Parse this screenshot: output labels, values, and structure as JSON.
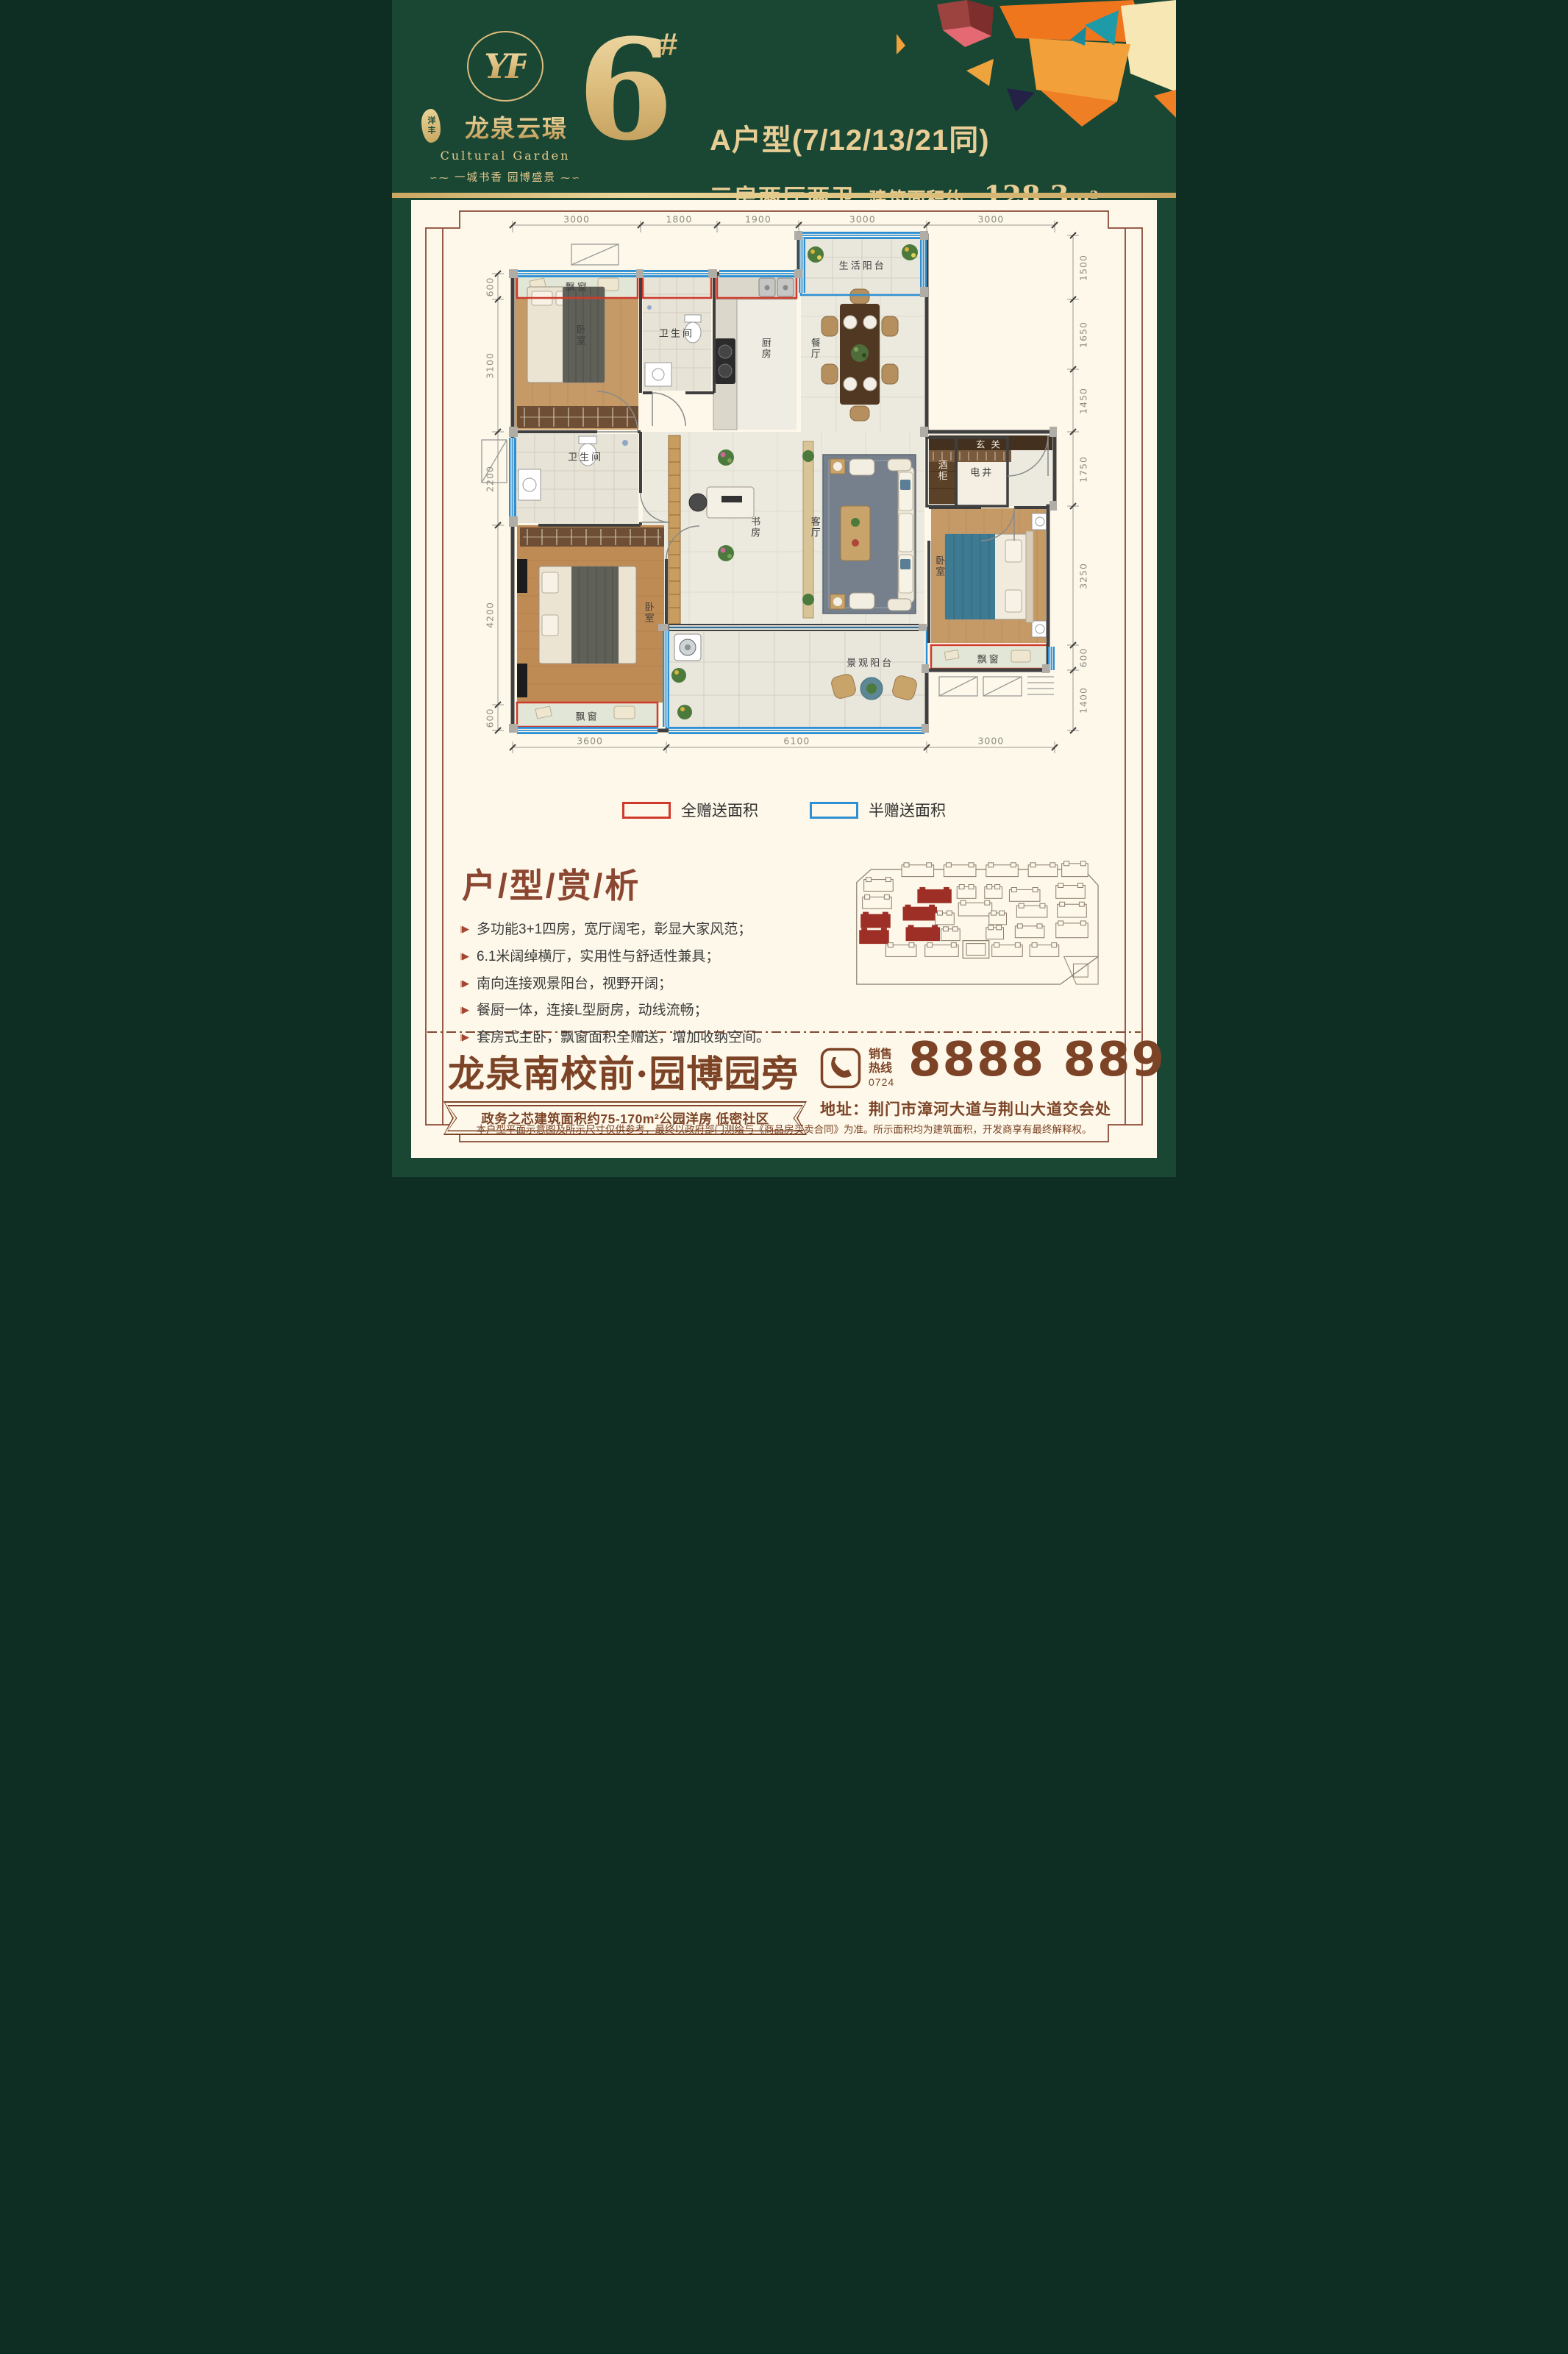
{
  "header": {
    "logo": {
      "monogram": "YF",
      "seal": "洋丰",
      "name": "龙泉云璟",
      "subtitle": "Cultural Garden",
      "tagline": "一城书香  园博盛景"
    },
    "building_no": "6",
    "building_no_suffix": "#",
    "unit_line": "A户型(7/12/13/21同)",
    "layout_line": "三房两厅两卫",
    "area_label": "建筑面积约：",
    "area_value": "128.3",
    "area_unit": "m²"
  },
  "floor_plan": {
    "dims_top": [
      "3000",
      "1800",
      "1900",
      "3000",
      "3000"
    ],
    "dims_left": [
      "600",
      "3100",
      "2200",
      "4200",
      "600"
    ],
    "dims_right": [
      "1500",
      "1650",
      "1450",
      "1750",
      "3250",
      "600",
      "1400"
    ],
    "dims_bottom": [
      "3600",
      "6100",
      "3000"
    ],
    "labels": {
      "bay1": "飘窗",
      "bedroom1": "卧室",
      "bath1": "卫生间",
      "kitchen": "厨房",
      "dining": "餐厅",
      "service_balcony": "生活阳台",
      "wine_cabinet": "酒柜",
      "shaft": "电井",
      "bath2": "卫生间",
      "master_bedroom": "卧室",
      "study": "书房",
      "living": "客厅",
      "foyer": "玄关",
      "bedroom3": "卧室",
      "bay3": "飘窗",
      "bay2": "飘窗",
      "view_balcony": "景观阳台"
    }
  },
  "legend": {
    "full": {
      "label": "全赠送面积",
      "color": "#cf3a2c"
    },
    "half": {
      "label": "半赠送面积",
      "color": "#2e8fd2"
    }
  },
  "analysis": {
    "title": "户/型/赏/析",
    "bullets": [
      "多功能3+1四房，宽厅阔宅，彰显大家风范；",
      "6.1米阔绰横厅，实用性与舒适性兼具；",
      "南向连接观景阳台，视野开阔；",
      "餐厨一体，连接L型厨房，动线流畅；",
      "套房式主卧，飘窗面积全赠送，增加收纳空间。"
    ]
  },
  "siteplan": {
    "highlight_color": "#9e2f26",
    "buildings": [
      [
        82,
        22,
        44,
        16,
        0
      ],
      [
        140,
        22,
        44,
        16,
        0
      ],
      [
        198,
        22,
        44,
        16,
        0
      ],
      [
        256,
        22,
        40,
        16,
        0
      ],
      [
        302,
        20,
        36,
        18,
        0
      ],
      [
        30,
        42,
        40,
        16,
        0
      ],
      [
        104,
        56,
        46,
        18,
        1
      ],
      [
        158,
        52,
        26,
        16,
        0
      ],
      [
        196,
        52,
        24,
        16,
        0
      ],
      [
        230,
        56,
        42,
        16,
        0
      ],
      [
        294,
        50,
        40,
        18,
        0
      ],
      [
        28,
        66,
        40,
        16,
        0
      ],
      [
        160,
        74,
        46,
        18,
        0
      ],
      [
        240,
        78,
        42,
        16,
        0
      ],
      [
        296,
        76,
        40,
        18,
        0
      ],
      [
        84,
        80,
        46,
        18,
        1
      ],
      [
        26,
        90,
        40,
        18,
        1
      ],
      [
        128,
        88,
        26,
        16,
        0
      ],
      [
        202,
        88,
        24,
        16,
        0
      ],
      [
        88,
        108,
        46,
        18,
        1
      ],
      [
        136,
        110,
        26,
        16,
        0
      ],
      [
        198,
        108,
        24,
        16,
        0
      ],
      [
        238,
        106,
        40,
        16,
        0
      ],
      [
        294,
        102,
        44,
        20,
        0
      ],
      [
        24,
        112,
        40,
        18,
        1
      ],
      [
        60,
        132,
        42,
        16,
        0
      ],
      [
        114,
        132,
        46,
        16,
        0
      ],
      [
        206,
        132,
        42,
        16,
        0
      ],
      [
        258,
        132,
        40,
        16,
        0
      ]
    ]
  },
  "footer": {
    "headline": "龙泉南校前·园博园旁",
    "ribbon": "政务之芯建筑面积约75-170m²公园洋房 低密社区",
    "hotline_label_top": "销售",
    "hotline_label_bottom": "热线",
    "hotline_area_code": "0724",
    "hotline_number": "8888 889",
    "address": "地址：荆门市漳河大道与荆山大道交会处",
    "disclaimer": "本户型平面示意图及所示尺寸仅供参考，最终以政府部门测绘与《商品房买卖合同》为准。所示面积均为建筑面积，开发商享有最终解释权。"
  }
}
